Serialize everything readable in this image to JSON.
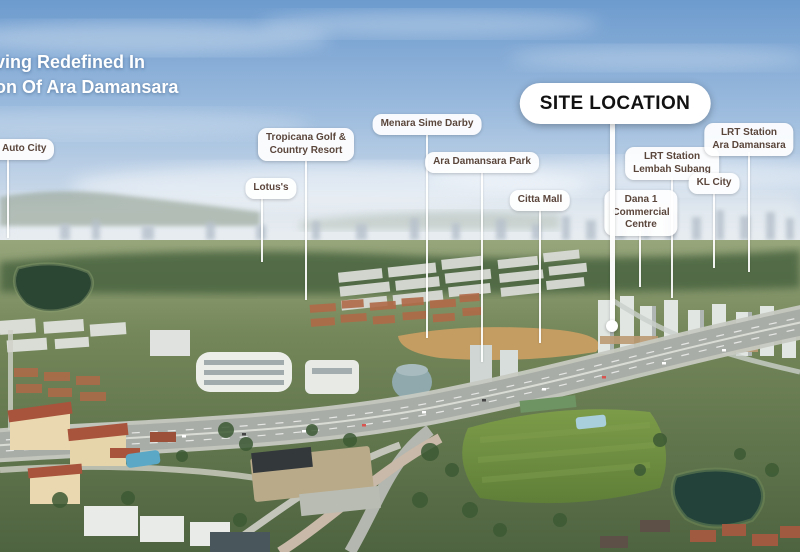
{
  "heading": {
    "line1": "ving Redefined In",
    "line2": "on Of Ara Damansara"
  },
  "site_callout": {
    "label": "SITE LOCATION",
    "x": 615,
    "top": 83,
    "line_x": 612,
    "line_top": 120,
    "line_bottom": 322,
    "dot_y": 326
  },
  "labels": [
    {
      "id": "auto-city",
      "lines": [
        "y Auto City"
      ],
      "x": 28,
      "top": 139,
      "line_x": 8,
      "line_top": 160,
      "line_bottom": 238,
      "edge": "left"
    },
    {
      "id": "tropicana-golf-country-resort",
      "lines": [
        "Tropicana Golf &",
        "Country Resort"
      ],
      "x": 306,
      "top": 128,
      "line_x": 306,
      "line_top": 161,
      "line_bottom": 300
    },
    {
      "id": "lotus",
      "lines": [
        "Lotus's"
      ],
      "x": 271,
      "top": 178,
      "line_x": 262,
      "line_top": 197,
      "line_bottom": 262
    },
    {
      "id": "menara-sime-darby",
      "lines": [
        "Menara Sime Darby"
      ],
      "x": 427,
      "top": 114,
      "line_x": 427,
      "line_top": 135,
      "line_bottom": 338
    },
    {
      "id": "ara-damansara-park",
      "lines": [
        "Ara Damansara Park"
      ],
      "x": 482,
      "top": 152,
      "line_x": 482,
      "line_top": 172,
      "line_bottom": 362
    },
    {
      "id": "citta-mall",
      "lines": [
        "Citta Mall"
      ],
      "x": 540,
      "top": 190,
      "line_x": 540,
      "line_top": 210,
      "line_bottom": 343
    },
    {
      "id": "lrt-station-lembah-subang",
      "lines": [
        "LRT Station",
        "Lembah Subang"
      ],
      "x": 672,
      "top": 147,
      "line_x": 672,
      "line_top": 177,
      "line_bottom": 298
    },
    {
      "id": "dana-1-commercial-centre",
      "lines": [
        "Dana 1",
        "Commercial",
        "Centre"
      ],
      "x": 641,
      "top": 190,
      "line_x": 640,
      "line_top": 231,
      "line_bottom": 287
    },
    {
      "id": "kl-city",
      "lines": [
        "KL City"
      ],
      "x": 714,
      "top": 173,
      "line_x": 714,
      "line_top": 193,
      "line_bottom": 268
    },
    {
      "id": "lrt-station-ara-damansara",
      "lines": [
        "LRT Station",
        "Ara Damansara"
      ],
      "x": 749,
      "top": 123,
      "line_x": 749,
      "line_top": 152,
      "line_bottom": 272
    }
  ],
  "colors": {
    "heading_text": "#ffffff",
    "pill_bg": "#ffffff",
    "pill_text": "#5b463c",
    "site_pill_bg": "#ffffff",
    "site_pill_text": "#121212",
    "leader_line": "#ffffff"
  }
}
